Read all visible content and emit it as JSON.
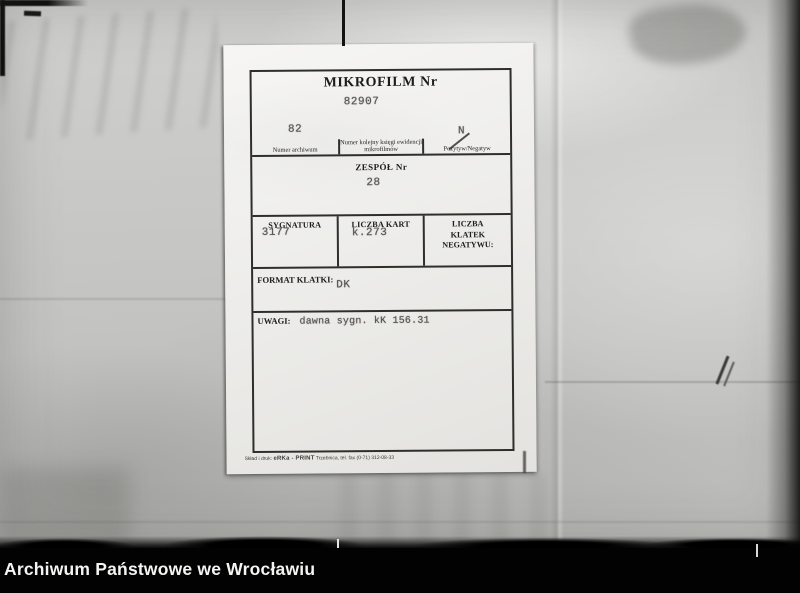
{
  "card": {
    "title": "MIKROFILM Nr",
    "number": "82907",
    "archive_row": {
      "numer_archiwum": {
        "value": "82",
        "label": "Numer archiwum"
      },
      "ksiega": {
        "value": "",
        "label": "Numer kolejny księgi ewidencji mikrofilmów"
      },
      "pozytyw_negatyw": {
        "value": "N",
        "label": "Pozytyw/Negatyw"
      }
    },
    "zespol": {
      "label": "ZESPÓŁ Nr",
      "value": "28"
    },
    "details_row": {
      "sygnatura": {
        "label": "SYGNATURA",
        "value": "3177"
      },
      "liczba_kart": {
        "label": "LICZBA KART",
        "value": "k.273"
      },
      "liczba_klatek": {
        "label": "LICZBA KLATEK NEGATYWU:",
        "value": ""
      }
    },
    "format_klatki": {
      "label": "FORMAT KLATKI:",
      "value": "DK"
    },
    "uwagi": {
      "label": "UWAGI:",
      "value": "dawna sygn. kK 156.31"
    },
    "print_credit": {
      "prefix": "Skład i druk:",
      "brand": "eRKa - PRINT",
      "suffix": "Trzebnica, tel. fax (0-71) 312-08-33"
    }
  },
  "footer": {
    "label": "Archiwum Państwowe we Wrocławiu"
  },
  "colors": {
    "film_background": "#c8c8c6",
    "card_paper": "#edece9",
    "ink": "#2e2e2a",
    "typewriter_ink": "#55534f",
    "footer_bar": "#020202",
    "footer_text": "#f4f4f2"
  }
}
